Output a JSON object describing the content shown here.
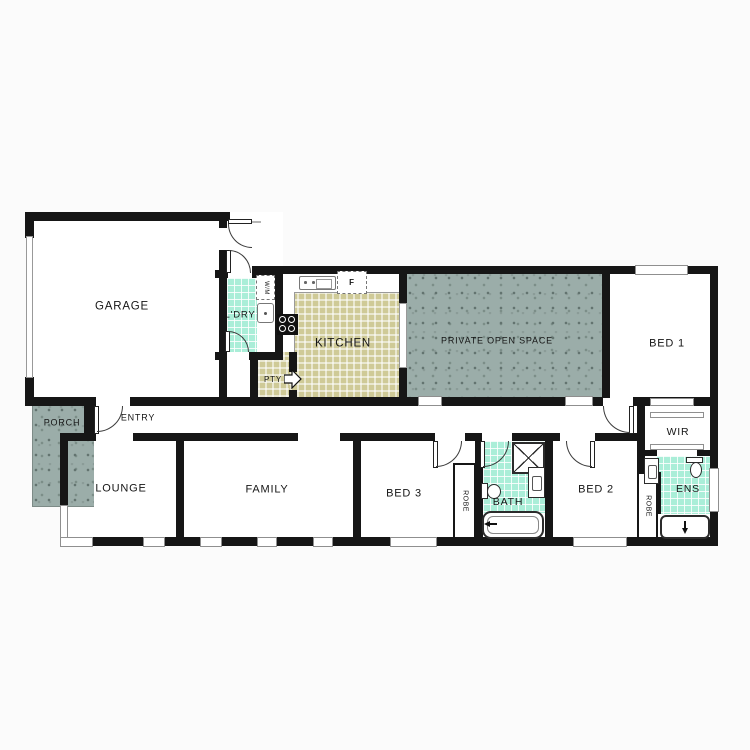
{
  "floorplan": {
    "labels": {
      "garage": "GARAGE",
      "porch": "PORCH",
      "entry": "ENTRY",
      "laundry": "L'DRY",
      "washing_machine": "W/M",
      "pantry": "PTY",
      "kitchen": "KITCHEN",
      "fridge": "F",
      "private_open_space": "PRIVATE OPEN SPACE",
      "bed1": "BED 1",
      "wir": "WIR",
      "ens": "ENS",
      "robe": "ROBE",
      "lounge": "LOUNGE",
      "family": "FAMILY",
      "bed3": "BED 3",
      "bath": "BATH",
      "bed2": "BED 2"
    },
    "colors": {
      "wall": "#161616",
      "mint_tile": "#aaeed8",
      "khaki_tile": "#cfca97",
      "outdoor_surface": "#9bada9",
      "floor": "#ffffff"
    }
  }
}
